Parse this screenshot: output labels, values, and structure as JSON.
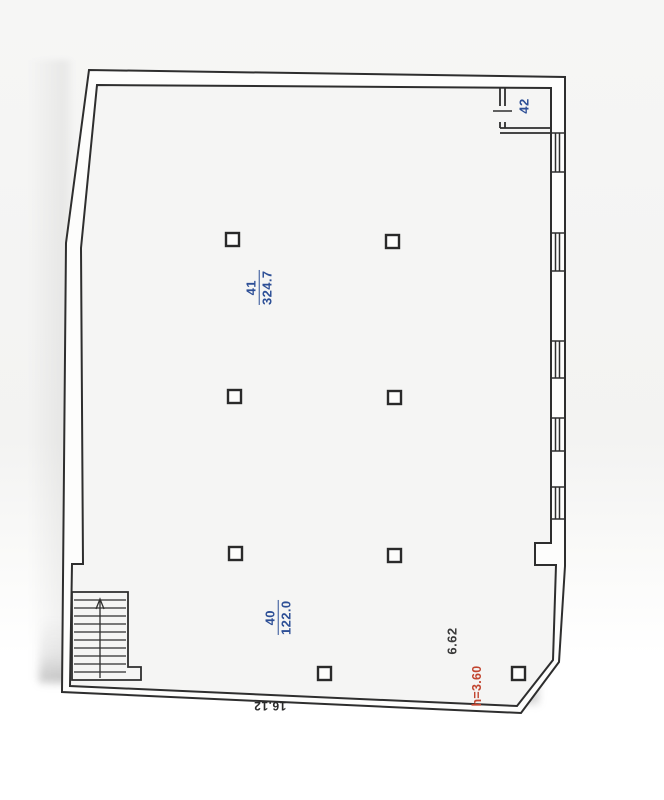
{
  "plan": {
    "title": "floor-plan-scan",
    "rooms": [
      {
        "number": "41",
        "area": "324.7"
      },
      {
        "number": "40",
        "area": "122.0"
      },
      {
        "number": "42"
      }
    ],
    "dimensions": {
      "bottom_width": "16.12",
      "right_depth": "6.62",
      "ceiling_height": "h=3.60"
    },
    "colors": {
      "room_label_blue": "#2d4f96",
      "height_label_red": "#c2452f",
      "wall_line": "#2e2e2e",
      "paper": "#f4f4f3"
    }
  }
}
